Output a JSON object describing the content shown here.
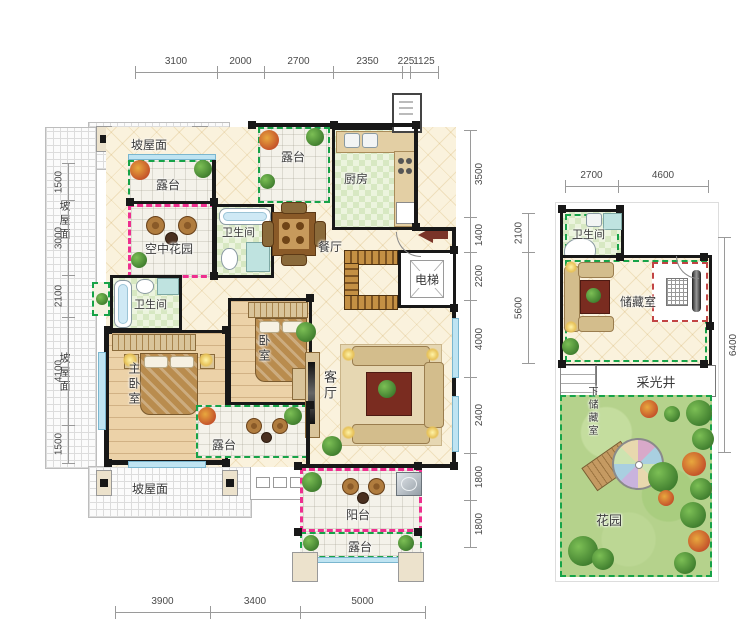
{
  "title": "住宅户型图 (residential floor plan)",
  "colors": {
    "terrace_dash": "#17a348",
    "garden_dash": "#ee2f8f",
    "wall": "#181818",
    "window": "#bfe4f2",
    "lawn": "#b5d28c",
    "entry_arrow": "#7a3428",
    "tile_floor": "#faf2dd",
    "wood_floor": "#ecd2a8",
    "kitchen_floor": "#d7e8c2"
  },
  "labels": {
    "roof": "坡屋面",
    "terrace": "露台",
    "sky_garden": "空中花园",
    "bathroom": "卫生间",
    "kitchen": "厨房",
    "dining": "餐厅",
    "elevator": "电梯",
    "master_bedroom": "主卧室",
    "bedroom": "卧室",
    "living": "客厅",
    "balcony": "阳台",
    "storage": "储藏室",
    "light_well": "采光井",
    "down_to_storage": "下储藏室",
    "garden": "花园"
  },
  "dimensions": {
    "main_top": [
      "3100",
      "2000",
      "2700",
      "2350",
      "225",
      "1125"
    ],
    "main_left": [
      "1500",
      "3000",
      "2100",
      "4100",
      "1500"
    ],
    "main_right": [
      "3500",
      "1400",
      "2200",
      "4000",
      "2400",
      "1800",
      "1800"
    ],
    "main_bottom": [
      "3900",
      "3400",
      "5000"
    ],
    "annex_top": [
      "2700",
      "4600"
    ],
    "annex_left": [
      "2100",
      "5600"
    ],
    "annex_right": [
      "6400"
    ]
  }
}
